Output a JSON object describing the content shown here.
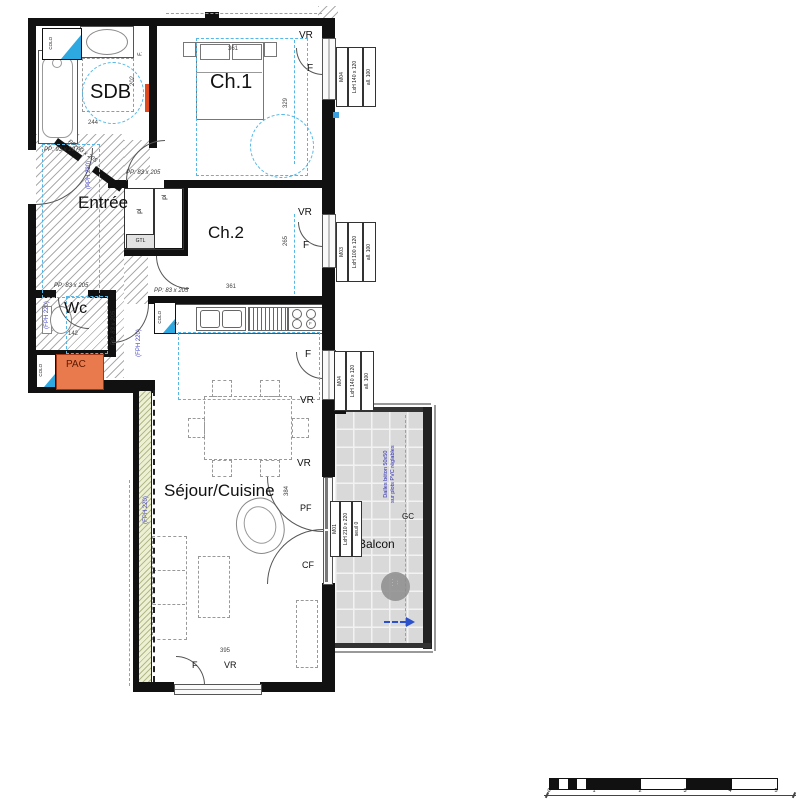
{
  "rooms": {
    "sdb": "SDB",
    "ch1": "Ch.1",
    "entree": "Entrée",
    "ch2": "Ch.2",
    "wc": "Wc",
    "pac": "PAC",
    "sejour": "Séjour/Cuisine",
    "balcon": "Balcon"
  },
  "openings": {
    "vr": "VR",
    "f": "F",
    "pf": "PF",
    "cf": "CF",
    "gc": "GC",
    "tags": [
      {
        "id": "M04",
        "dim": "LxH 140 x 120",
        "sill": "all. 100"
      },
      {
        "id": "M03",
        "dim": "LxH 100 x 120",
        "sill": "all. 100"
      },
      {
        "id": "M04",
        "dim": "LxH 140 x 120",
        "sill": "all. 100"
      },
      {
        "id": "M01",
        "dim": "LxH 210 x 220",
        "sill": "seuil 0"
      }
    ]
  },
  "doors": {
    "entry": "PP: 93 x 207",
    "std": "PP: 83 x 205"
  },
  "annotations": {
    "pph": "(PPH 220)",
    "fph": "(FPH 220)",
    "gtl": "GTL",
    "pl": "pl",
    "colo": "COLO",
    "lv": "LV",
    "f_dot": "F.",
    "f_small": "F",
    "balcony_note_1": "Dalles béton 50x50",
    "balcony_note_2": "sur plots PVC réglables"
  },
  "dimensions": {
    "ch1_w": "361",
    "ch1_h": "329",
    "sdb_h": "202",
    "sdb_w": "244",
    "ch2_w": "361",
    "ch2_h": "265",
    "wc_w": "142",
    "sejour_w": "395",
    "sejour_h": "384"
  },
  "stamp": {
    "l1": "· · ·",
    "l2": "· ·"
  },
  "scale_bar": {
    "ticks": [
      "0",
      "1",
      "2",
      "3",
      "4",
      "5"
    ]
  },
  "colors": {
    "wall": "#111111",
    "cyan_guide": "#53b7e8",
    "annotation_blue": "#4646c8",
    "pac_orange": "#e87a4e",
    "radiator_orange": "#e2491f",
    "balcony_fill": "#d9d9d9",
    "balcony_note_blue": "#2b2bb5",
    "flag_blue": "#2da8e0"
  }
}
